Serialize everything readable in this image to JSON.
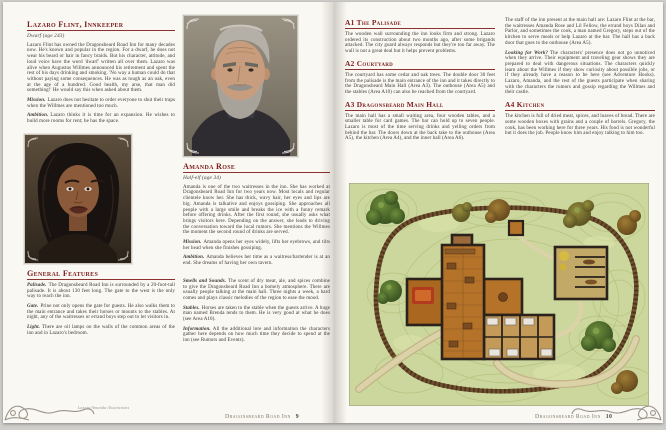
{
  "colors": {
    "page_background": "#faf8f2",
    "heading_accent": "#7b1d1d",
    "body_text": "#3b3733",
    "map_grass": "#ccd79d",
    "map_floor_wood": "#b5732a",
    "map_wall": "#2a221b"
  },
  "left_page": {
    "lazaro": {
      "heading": "Lazaro Flint, Innkeeper",
      "subtitle": "Dwarf (age 243)",
      "intro": "Lazaro Flint has owned the Dragonsbeard Road Inn for many decades now. He's known and popular in the region. For a dwarf, he does not wear his beard or hair in fancy braids. But his character, attitude, and loud voice have the word 'dwarf' written all over them. Lazaro was alive when Augustus Willmes announced his retirement and spent the rest of his days drinking and smoking. 'No way a human could do that without paying some consequences. He was as tough as an oak, even at the age of a hundred. Good health, my arse, that man did something!' He would say this when asked about them.",
      "mission_label": "Mission.",
      "mission": "Lazaro does not hesitate to order everyone to shut their traps when the Willmes are mentioned too much.",
      "ambition_label": "Ambition.",
      "ambition": "Lazaro thinks it is time for an expansion. He wishes to build more rooms for rent; he has the space."
    },
    "amanda": {
      "heading": "Amanda Rose",
      "subtitle": "Half-elf (age 34)",
      "intro": "Amanda is one of the two waitresses in the inn. She has worked at Dragonsbeard Road Inn for two years now. Most locals and regular clientele know her. She has thick, wavy hair, her eyes and lips are big. Amanda is talkative and enjoys gossiping. She approaches all people with a large smile and breaks the ice with a funny remark before offering drinks. After the first round, she usually asks what brings visitors here. Depending on the answer, she leads to driving the conversation toward the local rumors. She mentions the Willmes the moment the second round of drinks are served.",
      "mission_label": "Mission.",
      "mission": "Amanda opens her eyes widely, lifts her eyebrows, and tilts her head when she finishes gossiping.",
      "ambition_label": "Ambition.",
      "ambition": "Amanda believes her time as a waitress/bartender is at an end. She dreams of having her own tavern."
    },
    "general": {
      "heading": "General Features",
      "items": [
        {
          "label": "Palisade.",
          "text": "The Dragonsbeard Road Inn is surrounded by a 20-foot-tall palisade. It is about 130 feet long. The gate to the west is the only way to reach the inn."
        },
        {
          "label": "Gate.",
          "text": "Prine not only opens the gate for guests. He also walks them to the main entrance and takes their horses or mounts to the stables. At night, any of the waitresses or errand boys step out to let visitors in."
        },
        {
          "label": "Light.",
          "text": "There are oil lamps on the walls of the common areas of the inn and in Lazaro's bedroom."
        }
      ]
    },
    "extras": [
      {
        "label": "Smells and Sounds.",
        "text": "The scent of dry meat, ale, and spices combine to give the Dragonsbeard Road Inn a homely atmosphere. There are usually people talking at the main hall. Three nights a week, a bard comes and plays classic melodies of the region to ease the mood."
      },
      {
        "label": "Stables.",
        "text": "Horses are taken to the stable when the guests arrive. A huge man named Brenda tends to them. He is very good at what he does (see Area A10)."
      },
      {
        "label": "Information.",
        "text": "All the additional lore and information the characters gather here depends on how much time they decide to spend at the inn (see Rumors and Events)."
      }
    ]
  },
  "right_page": {
    "sections": [
      {
        "heading": "A1 The Palisade",
        "text": "The wooden wall surrounding the inn looks firm and strong. Lazaro ordered its construction about two months ago, after some brigands attacked. The city guard always responds but they're too far away. The wall is not a great deal but it helps prevent problems."
      },
      {
        "heading": "A2 Courtyard",
        "text": "The courtyard has some cedar and oak trees. The double door 30 feet from the palisade is the main entrance of the inn and it takes directly to the Dragonsbeard Main Hall (Area A3). The outhouse (Area A5) and the stables (Area A10) can also be reached from the courtyard."
      },
      {
        "heading": "A3 Dragonsbeard Main Hall",
        "text": "The main hall has a small waiting area, four wooden tables, and a smaller table for card games. The bar can hold up to seven people. Lazaro is most of the time serving drinks and yelling orders from behind the bar. The doors down at the back take to the outhouse (Area A5), the kitchen (Area A4), and the inner hall (Area A6)."
      }
    ],
    "right_column": {
      "staff_text": "The staff of the inn present at the main hall are: Lazaro Flint at the bar, the waitresses Amanda Rose and Lil Fellow, the errand boys Dilan and Parlor, and sometimes the cook, a man named Gregory, steps out of the kitchen to serve meals or help Lazaro at the bar. The hall has a back door that goes to the outhouse (Area A5).",
      "looking_label": "Looking for Work?",
      "looking_text": "The characters' presence does not go unnoticed when they arrive. Their equipment and traveling gear shows they are prepared to deal with dangerous situations. The characters quickly learn about the Willmes if they show curiosity about possible jobs, or if they already have a reason to be here (see Adventure Hooks). Lazaro, Amanda, and the rest of the guests participate when sharing with the characters the rumors and gossip regarding the Willmes and their castle.",
      "kitchen_heading": "A4 Kitchen",
      "kitchen_text": "The kitchen is full of dried meat, spices, and loaves of bread. There are some wooden boxes with grains and a couple of barrels. Gregory, the cook, has been working here for three years. His food is not wonderful but it does the job. People know him and enjoy talking to him too."
    },
    "map_features": [
      "palisade-ring",
      "inn-building",
      "stables-building",
      "shed",
      "courtyard-paths",
      "trees"
    ]
  },
  "footer": {
    "note": "Lazaro/Amanda illustrations",
    "title_left": "Dragonsbeard Road Inn",
    "page_left": "9",
    "title_right": "Dragonsbeard Road Inn",
    "page_right": "10"
  }
}
